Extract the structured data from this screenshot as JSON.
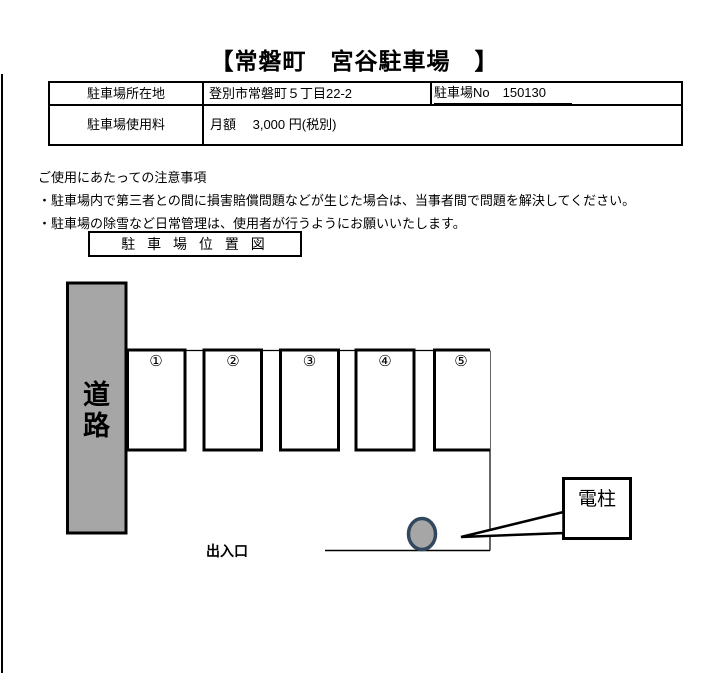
{
  "title": "【常磐町　宮谷駐車場　】",
  "info_table": {
    "location_label": "駐車場所在地",
    "location_value": "登別市常磐町５丁目22-2",
    "parking_no": "駐車場No　150130",
    "fee_label": "駐車場使用料",
    "fee_value": "月額　 3,000 円(税別)"
  },
  "notes": {
    "heading": "ご使用にあたっての注意事項",
    "items": [
      "・駐車場内で第三者との間に損害賠償問題などが生じた場合は、当事者間で問題を解決してください。",
      "・駐車場の除雪など日常管理は、使用者が行うようにお願いいたします。"
    ]
  },
  "map": {
    "section_title": "駐 車 場 位 置 図",
    "road_chars": [
      "道",
      "路"
    ],
    "space_numbers": [
      "①",
      "②",
      "③",
      "④",
      "⑤"
    ],
    "entrance_label": "出入口",
    "pole_label": "電柱",
    "colors": {
      "road_fill": "#A6A6A6",
      "pole_fill": "#A6A6A6",
      "pole_stroke": "#31485E"
    }
  }
}
